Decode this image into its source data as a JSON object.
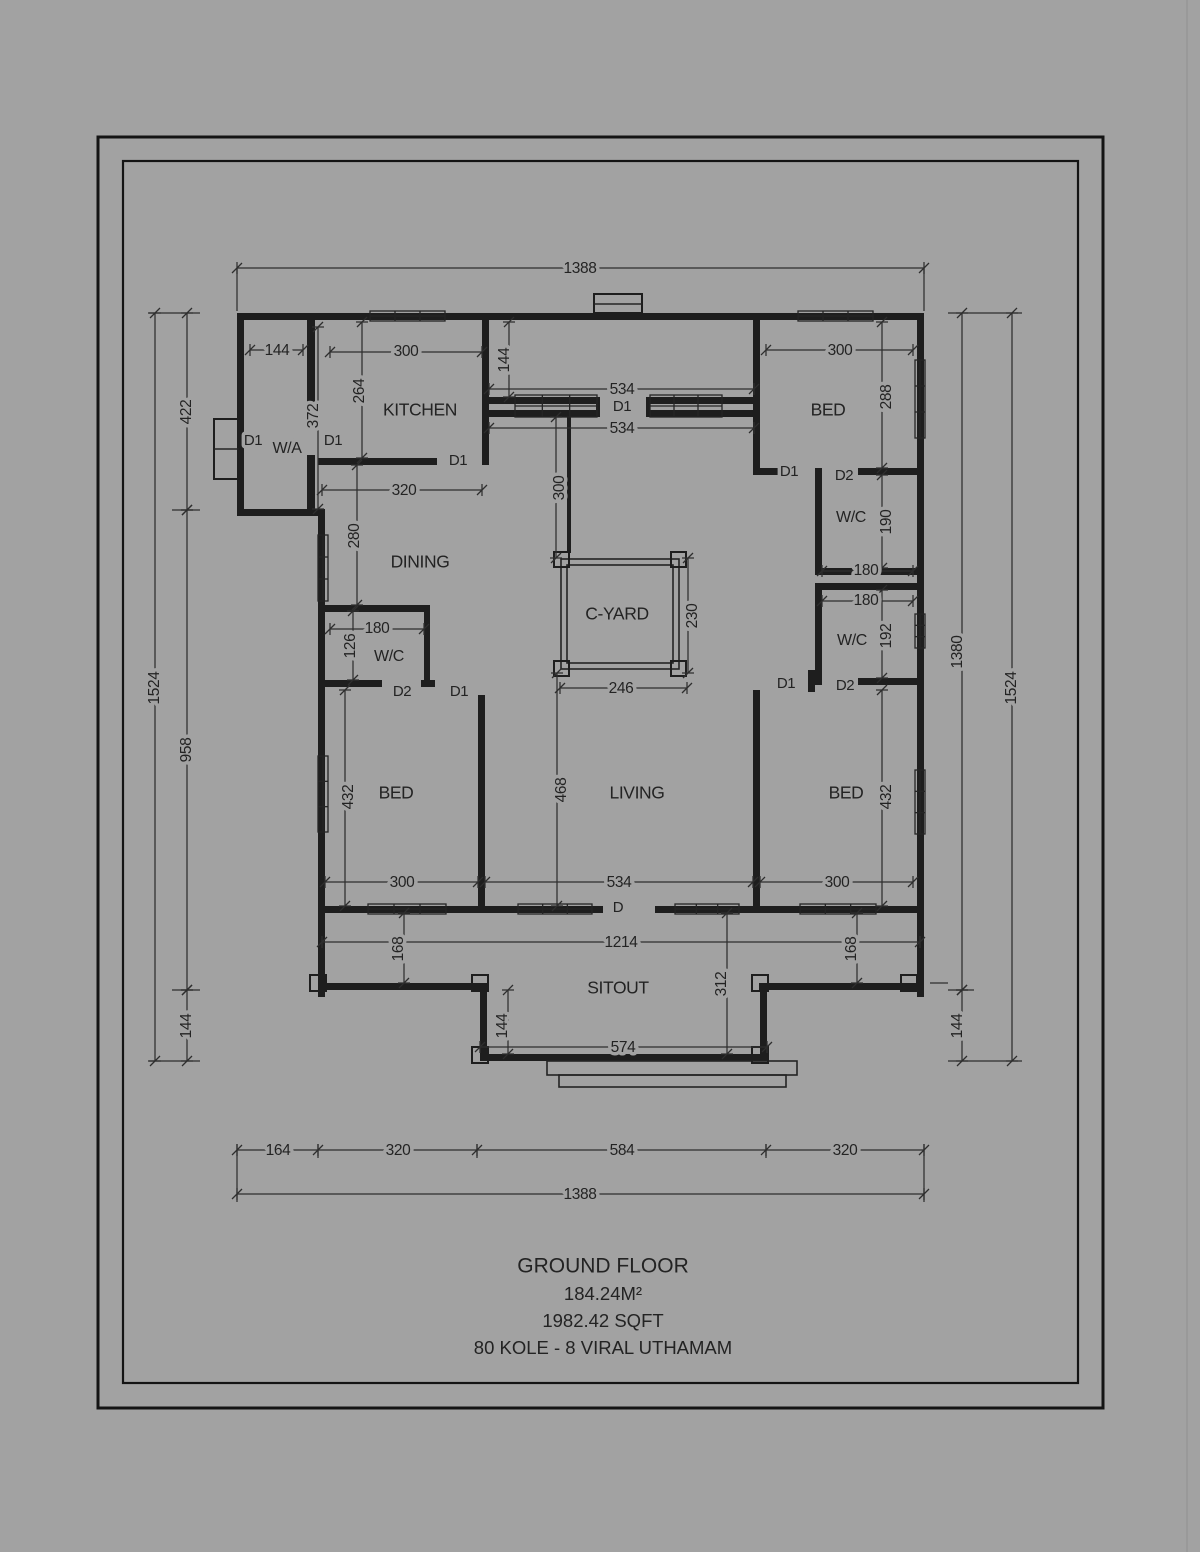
{
  "canvas": {
    "background": "#a2a2a2",
    "wall_color": "#1e1e1e",
    "dim_color": "#2e2e2e"
  },
  "title_block": {
    "line1": "GROUND FLOOR",
    "line2": "184.24M²",
    "line3": "1982.42 SQFT",
    "line4": "80 KOLE -  8 VIRAL UTHAMAM"
  },
  "labels": [
    {
      "id": "dim-top-1388",
      "text": "1388",
      "x": 580,
      "y": 269,
      "r": 0,
      "c": "dim"
    },
    {
      "id": "dim-wa-144",
      "text": "144",
      "x": 277,
      "y": 351,
      "r": 0,
      "c": "dim"
    },
    {
      "id": "dim-kitchen-300",
      "text": "300",
      "x": 406,
      "y": 352,
      "r": 0,
      "c": "dim"
    },
    {
      "id": "dim-bed1-300",
      "text": "300",
      "x": 840,
      "y": 351,
      "r": 0,
      "c": "dim"
    },
    {
      "id": "dim-corridor-144",
      "text": "144",
      "x": 505,
      "y": 360,
      "r": 1,
      "c": "dim"
    },
    {
      "id": "dim-534-upper",
      "text": "534",
      "x": 622,
      "y": 390,
      "r": 0,
      "c": "dim"
    },
    {
      "id": "door-d1-corridor",
      "text": "D1",
      "x": 622,
      "y": 407,
      "r": 0,
      "c": "door"
    },
    {
      "id": "dim-534-lower",
      "text": "534",
      "x": 622,
      "y": 429,
      "r": 0,
      "c": "dim"
    },
    {
      "id": "dim-bed1-288",
      "text": "288",
      "x": 887,
      "y": 397,
      "r": 1,
      "c": "dim"
    },
    {
      "id": "room-kitchen",
      "text": "KITCHEN",
      "x": 420,
      "y": 411,
      "r": 0,
      "c": "room"
    },
    {
      "id": "room-bed1",
      "text": "BED",
      "x": 828,
      "y": 411,
      "r": 0,
      "c": "room"
    },
    {
      "id": "door-d1-wa-ext",
      "text": "D1",
      "x": 253,
      "y": 441,
      "r": 0,
      "c": "door"
    },
    {
      "id": "room-wa",
      "text": "W/A",
      "x": 287,
      "y": 449,
      "r": 0,
      "c": "room-sm"
    },
    {
      "id": "door-d1-wa-kitchen",
      "text": "D1",
      "x": 333,
      "y": 441,
      "r": 0,
      "c": "door"
    },
    {
      "id": "dim-wa-372",
      "text": "372",
      "x": 314,
      "y": 416,
      "r": 1,
      "c": "dim"
    },
    {
      "id": "dim-kitchen-264",
      "text": "264",
      "x": 360,
      "y": 391,
      "r": 1,
      "c": "dim"
    },
    {
      "id": "door-d1-kitchen",
      "text": "D1",
      "x": 458,
      "y": 461,
      "r": 0,
      "c": "door"
    },
    {
      "id": "dim-kitchen-320",
      "text": "320",
      "x": 404,
      "y": 491,
      "r": 0,
      "c": "dim"
    },
    {
      "id": "dim-corridor-300",
      "text": "300",
      "x": 560,
      "y": 488,
      "r": 1,
      "c": "dim"
    },
    {
      "id": "dim-dining-280",
      "text": "280",
      "x": 355,
      "y": 536,
      "r": 1,
      "c": "dim"
    },
    {
      "id": "room-dining",
      "text": "DINING",
      "x": 420,
      "y": 563,
      "r": 0,
      "c": "room"
    },
    {
      "id": "door-d1-bed1",
      "text": "D1",
      "x": 789,
      "y": 472,
      "r": 0,
      "c": "door"
    },
    {
      "id": "door-d2-wc1",
      "text": "D2",
      "x": 844,
      "y": 476,
      "r": 0,
      "c": "door"
    },
    {
      "id": "room-wc1",
      "text": "W/C",
      "x": 851,
      "y": 518,
      "r": 0,
      "c": "room-sm"
    },
    {
      "id": "dim-wc1-190",
      "text": "190",
      "x": 887,
      "y": 522,
      "r": 1,
      "c": "dim"
    },
    {
      "id": "dim-wc1-180",
      "text": "180",
      "x": 866,
      "y": 571,
      "r": 0,
      "c": "dim"
    },
    {
      "id": "dim-wc2-180",
      "text": "180",
      "x": 866,
      "y": 601,
      "r": 0,
      "c": "dim"
    },
    {
      "id": "room-wc2",
      "text": "W/C",
      "x": 852,
      "y": 641,
      "r": 0,
      "c": "room-sm"
    },
    {
      "id": "dim-wc2-192",
      "text": "192",
      "x": 887,
      "y": 636,
      "r": 1,
      "c": "dim"
    },
    {
      "id": "room-cyard",
      "text": "C-YARD",
      "x": 617,
      "y": 615,
      "r": 0,
      "c": "room"
    },
    {
      "id": "dim-cyard-230",
      "text": "230",
      "x": 693,
      "y": 616,
      "r": 1,
      "c": "dim"
    },
    {
      "id": "dim-cyard-246",
      "text": "246",
      "x": 621,
      "y": 689,
      "r": 0,
      "c": "dim"
    },
    {
      "id": "dim-wcl-180",
      "text": "180",
      "x": 377,
      "y": 629,
      "r": 0,
      "c": "dim"
    },
    {
      "id": "dim-wcl-126",
      "text": "126",
      "x": 351,
      "y": 646,
      "r": 1,
      "c": "dim"
    },
    {
      "id": "room-wcl",
      "text": "W/C",
      "x": 389,
      "y": 657,
      "r": 0,
      "c": "room-sm"
    },
    {
      "id": "door-d2-wcl",
      "text": "D2",
      "x": 402,
      "y": 692,
      "r": 0,
      "c": "door"
    },
    {
      "id": "door-d1-bedl",
      "text": "D1",
      "x": 459,
      "y": 692,
      "r": 0,
      "c": "door"
    },
    {
      "id": "door-d1-bed2",
      "text": "D1",
      "x": 786,
      "y": 684,
      "r": 0,
      "c": "door"
    },
    {
      "id": "door-d2-wc2",
      "text": "D2",
      "x": 845,
      "y": 686,
      "r": 0,
      "c": "door"
    },
    {
      "id": "room-bedl",
      "text": "BED",
      "x": 396,
      "y": 794,
      "r": 0,
      "c": "room"
    },
    {
      "id": "dim-bedl-432",
      "text": "432",
      "x": 349,
      "y": 797,
      "r": 1,
      "c": "dim"
    },
    {
      "id": "dim-living-468",
      "text": "468",
      "x": 562,
      "y": 790,
      "r": 1,
      "c": "dim"
    },
    {
      "id": "room-living",
      "text": "LIVING",
      "x": 637,
      "y": 794,
      "r": 0,
      "c": "room"
    },
    {
      "id": "room-bed2",
      "text": "BED",
      "x": 846,
      "y": 794,
      "r": 0,
      "c": "room"
    },
    {
      "id": "dim-bed2-432",
      "text": "432",
      "x": 887,
      "y": 797,
      "r": 1,
      "c": "dim"
    },
    {
      "id": "dim-bedl-300",
      "text": "300",
      "x": 402,
      "y": 883,
      "r": 0,
      "c": "dim"
    },
    {
      "id": "dim-living-534",
      "text": "534",
      "x": 619,
      "y": 883,
      "r": 0,
      "c": "dim"
    },
    {
      "id": "dim-bed2-300",
      "text": "300",
      "x": 837,
      "y": 883,
      "r": 0,
      "c": "dim"
    },
    {
      "id": "door-d-living",
      "text": "D",
      "x": 618,
      "y": 908,
      "r": 0,
      "c": "door"
    },
    {
      "id": "dim-1214",
      "text": "1214",
      "x": 621,
      "y": 943,
      "r": 0,
      "c": "dim"
    },
    {
      "id": "dim-168-left",
      "text": "168",
      "x": 399,
      "y": 949,
      "r": 1,
      "c": "dim"
    },
    {
      "id": "dim-168-right",
      "text": "168",
      "x": 852,
      "y": 949,
      "r": 1,
      "c": "dim"
    },
    {
      "id": "room-sitout",
      "text": "SITOUT",
      "x": 618,
      "y": 989,
      "r": 0,
      "c": "room"
    },
    {
      "id": "dim-sitout-312",
      "text": "312",
      "x": 722,
      "y": 984,
      "r": 1,
      "c": "dim"
    },
    {
      "id": "dim-sitout-144",
      "text": "144",
      "x": 503,
      "y": 1026,
      "r": 1,
      "c": "dim"
    },
    {
      "id": "dim-sitout-574",
      "text": "574",
      "x": 623,
      "y": 1048,
      "r": 0,
      "c": "dim"
    },
    {
      "id": "dim-left-422",
      "text": "422",
      "x": 187,
      "y": 412,
      "r": 1,
      "c": "dim"
    },
    {
      "id": "dim-left-1524",
      "text": "1524",
      "x": 155,
      "y": 688,
      "r": 1,
      "c": "dim"
    },
    {
      "id": "dim-left-958",
      "text": "958",
      "x": 187,
      "y": 750,
      "r": 1,
      "c": "dim"
    },
    {
      "id": "dim-left-144",
      "text": "144",
      "x": 187,
      "y": 1026,
      "r": 1,
      "c": "dim"
    },
    {
      "id": "dim-right-1380",
      "text": "1380",
      "x": 958,
      "y": 652,
      "r": 1,
      "c": "dim"
    },
    {
      "id": "dim-right-1524",
      "text": "1524",
      "x": 1012,
      "y": 688,
      "r": 1,
      "c": "dim"
    },
    {
      "id": "dim-right-144",
      "text": "144",
      "x": 958,
      "y": 1026,
      "r": 1,
      "c": "dim"
    },
    {
      "id": "dim-bottom-164",
      "text": "164",
      "x": 278,
      "y": 1151,
      "r": 0,
      "c": "dim"
    },
    {
      "id": "dim-bottom-320a",
      "text": "320",
      "x": 398,
      "y": 1151,
      "r": 0,
      "c": "dim"
    },
    {
      "id": "dim-bottom-584",
      "text": "584",
      "x": 622,
      "y": 1151,
      "r": 0,
      "c": "dim"
    },
    {
      "id": "dim-bottom-320b",
      "text": "320",
      "x": 845,
      "y": 1151,
      "r": 0,
      "c": "dim"
    },
    {
      "id": "dim-bottom-1388",
      "text": "1388",
      "x": 580,
      "y": 1195,
      "r": 0,
      "c": "dim"
    }
  ]
}
